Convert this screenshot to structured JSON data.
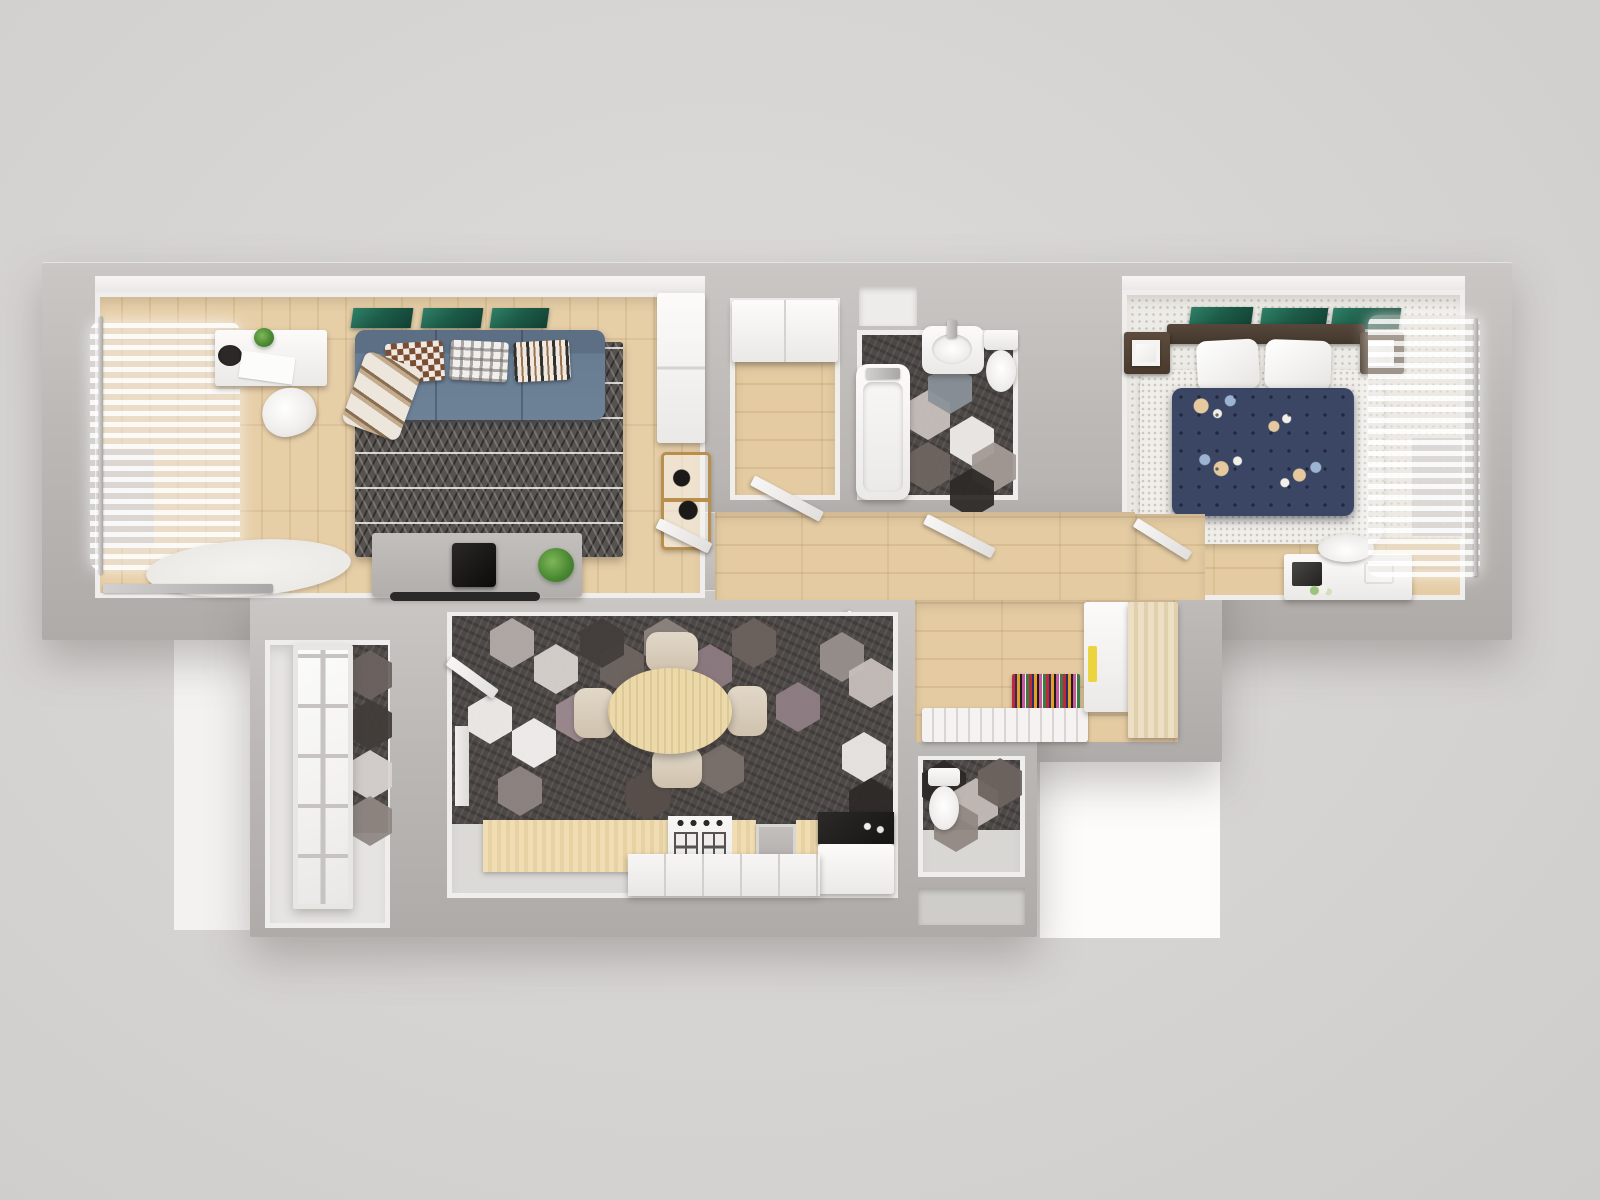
{
  "scene": {
    "title": "3D apartment floor plan - top-down render",
    "type": "architectural visualization",
    "view": "bird's-eye / top view",
    "rooms_count": 9
  },
  "palette": {
    "background": "#d6d4d2",
    "wall_top": "#bbb8b5",
    "inner_wall": "#f0eeec",
    "wood_floor": "#e0c69e",
    "wood_counter": "#efdcb3",
    "carpet_light": "#edebe6",
    "hex_dark": "#4e4946",
    "hex_white": "#f0edeb",
    "hex_mauve": "#8d7b82",
    "sofa_blue": "#687c92",
    "duvet_navy": "#3a4663",
    "art_green": "#1d5c49",
    "accent_yellow": "#ecd43e",
    "rug_dark": "#56524f",
    "runner_multicolor": "#c2283c",
    "fixture_white": "#fbfaf9",
    "counter_black": "#211f1e",
    "chrome": "#b9b7b5"
  },
  "rooms": {
    "living_room": {
      "label": "Living room",
      "floor": "light oak planks",
      "items": [
        "white desk with plant, black bowl and papers",
        "white shell chair",
        "sheer curtained window",
        "blue three-seat sofa with three patterned pillows and plaid throw",
        "dark triangle-pattern rug",
        "gray TV stand with black TV, soundbar and plant",
        "tall white cabinet",
        "gold bar cart",
        "white fluffy rug",
        "wall rail radiator",
        "three green art prints"
      ]
    },
    "storage_closet": {
      "label": "Storage closet",
      "floor": "wood planks",
      "items": [
        "white cabinet",
        "open white door"
      ]
    },
    "bathroom": {
      "label": "Bathroom",
      "floor": "hexagonal mosaic tile",
      "items": [
        "bathtub with chrome faucet",
        "oval washbasin",
        "toilet",
        "open white door"
      ]
    },
    "bedroom": {
      "label": "Bedroom",
      "floor": "light carpet with wood strip",
      "items": [
        "double bed with navy floral duvet and two white pillows",
        "dark wood headboard",
        "two dark wood nightstands with white lamps",
        "white fluffy rug",
        "white vanity desk with chair, photo frame and flowers",
        "sheer curtained window",
        "three green art prints"
      ]
    },
    "hallway": {
      "label": "Hallway",
      "floor": "light wood planks",
      "items": [
        "multicolour striped runner rug",
        "white slatted shoe bench",
        "white wardrobe with yellow handles",
        "light wood wardrobe",
        "open white doors"
      ]
    },
    "kitchen_dining": {
      "label": "Kitchen / dining room",
      "floor": "hexagonal mosaic tile",
      "items": [
        "oval wooden dining table",
        "four beige chairs",
        "wood counter with gas cooktop and sink",
        "white base cabinets",
        "black countertop",
        "open white door"
      ]
    },
    "balcony_vestibule": {
      "label": "Balcony vestibule",
      "floor": "hex tile and concrete",
      "items": [
        "white french glass door"
      ]
    },
    "wc": {
      "label": "WC",
      "floor": "hexagonal mosaic tile",
      "items": [
        "toilet"
      ]
    },
    "storage_niche": {
      "label": "Storage niche",
      "floor": "concrete",
      "items": []
    }
  },
  "furniture_labels": {
    "sofa": "Blue three-seat sofa",
    "living_rug": "Dark geometric rug",
    "tv_stand": "TV stand with television",
    "desk": "White desk",
    "bed": "Double bed with floral duvet",
    "bathtub": "Bathtub",
    "washbasin": "Washbasin",
    "toilet": "Toilet",
    "dining_table": "Oval dining table",
    "cooktop": "Gas cooktop",
    "balcony_door": "Glass balcony door",
    "wardrobe": "Wardrobe",
    "shoe_bench": "Slatted shoe bench",
    "runner_rug": "Multicolour runner rug"
  }
}
